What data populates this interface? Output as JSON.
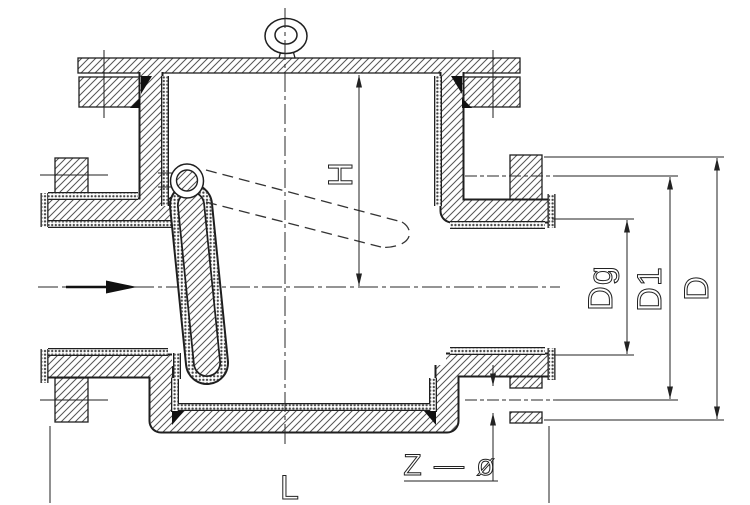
{
  "drawing": {
    "kind": "valve-section-drawing",
    "labels": {
      "h": "H",
      "dg": "Dg",
      "d1": "D1",
      "d": "D",
      "l": "L",
      "z_phi": "Z — ø"
    },
    "colors": {
      "line": "#1f1f1f",
      "background": "#ffffff"
    }
  }
}
